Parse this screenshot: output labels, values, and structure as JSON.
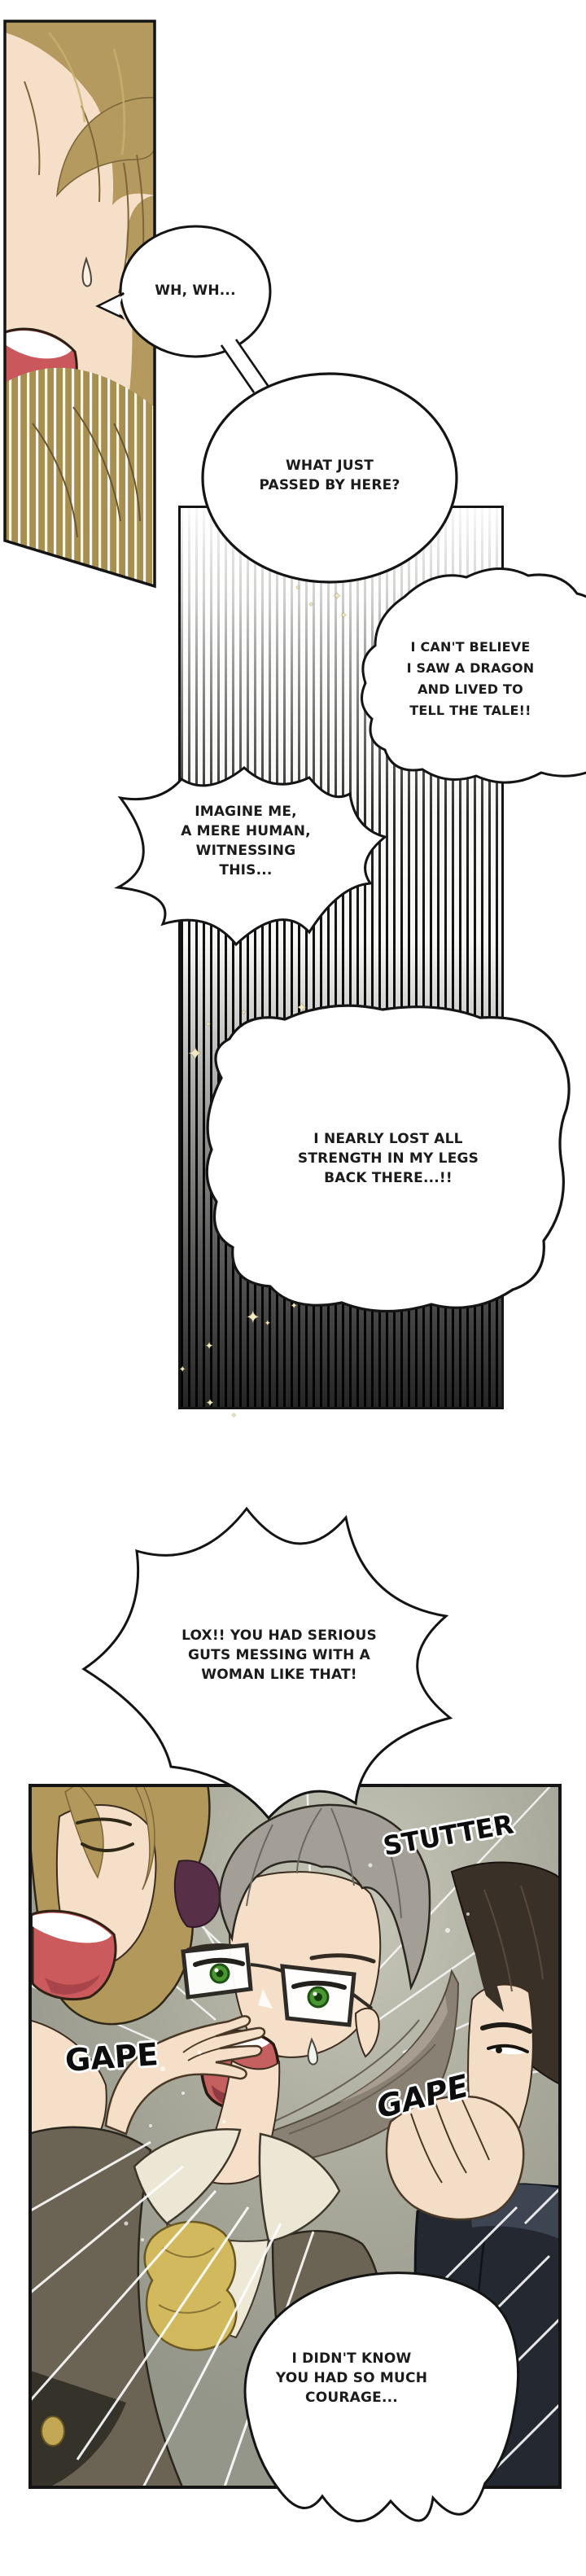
{
  "palette": {
    "ink": "#141414",
    "paper": "#ffffff",
    "skin": "#f6dfc9",
    "hair_blonde": "#b49a5e",
    "hair_ash_gray": "#a39f97",
    "hair_dark_brown": "#393028",
    "mouth_red": "#c4605f",
    "eye_green": "#4a9631",
    "cravat_yellow": "#d3b95e",
    "coat_olive": "#6b6455",
    "clothing_navy": "#242831",
    "panel_background_gray_green": "#a7a89a",
    "sparkle_cream": "#f0e9c2",
    "plum_garment": "#572f47"
  },
  "decor": {
    "sparkle_glyph": "✦"
  },
  "bubbles": [
    {
      "id": "b1",
      "style": "ellipse",
      "lines": [
        "WH, WH..."
      ]
    },
    {
      "id": "b2",
      "style": "ellipse",
      "lines": [
        "WHAT JUST",
        "PASSED BY HERE?"
      ]
    },
    {
      "id": "b3",
      "style": "cloud",
      "lines": [
        "I CAN'T BELIEVE",
        "I SAW A DRAGON",
        "AND LIVED TO",
        "TELL THE TALE!!"
      ]
    },
    {
      "id": "b4",
      "style": "cloud",
      "lines": [
        "IMAGINE ME,",
        "A MERE HUMAN,",
        "WITNESSING",
        "THIS..."
      ]
    },
    {
      "id": "b5",
      "style": "cloud",
      "lines": [
        "I NEARLY LOST ALL",
        "STRENGTH IN MY LEGS",
        "BACK THERE...!!"
      ]
    },
    {
      "id": "b6",
      "style": "burst",
      "lines": [
        "LOX!! YOU HAD SERIOUS",
        "GUTS MESSING WITH A",
        "WOMAN LIKE THAT!"
      ]
    },
    {
      "id": "b7",
      "style": "soft",
      "lines": [
        "I DIDN'T KNOW",
        "YOU HAD SO MUCH",
        "COURAGE..."
      ]
    }
  ],
  "sfx": [
    {
      "id": "stutter",
      "text": "STUTTER"
    },
    {
      "id": "gape_left",
      "text": "GAPE"
    },
    {
      "id": "gape_right",
      "text": "GAPE"
    }
  ]
}
